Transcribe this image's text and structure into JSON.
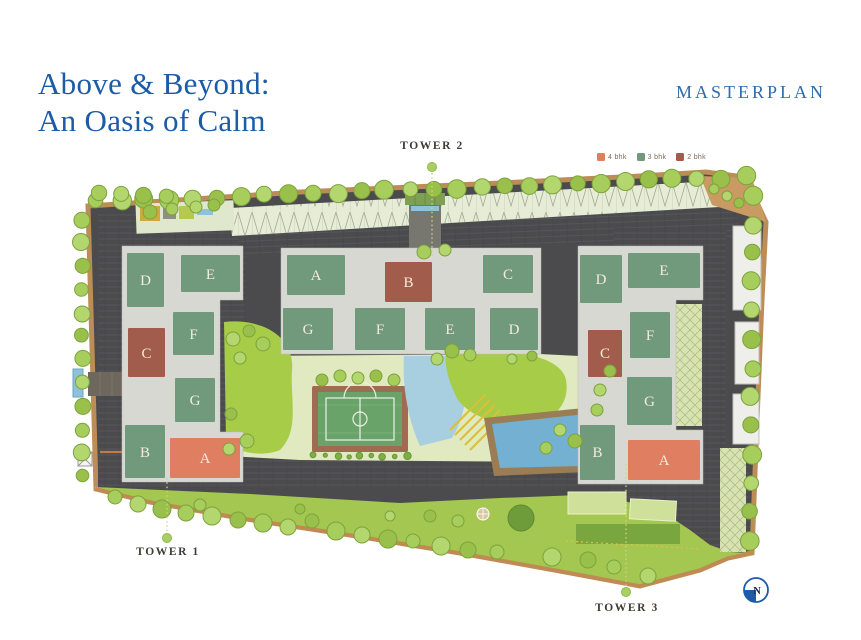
{
  "header": {
    "title_line1": "Above & Beyond:",
    "title_line2": "An Oasis of Calm",
    "corner_label": "MASTERPLAN"
  },
  "legend": {
    "items": [
      {
        "label": "4 bhk",
        "color": "#df7e60"
      },
      {
        "label": "3 bhk",
        "color": "#71997c"
      },
      {
        "label": "2 bhk",
        "color": "#a25c4b"
      }
    ]
  },
  "towers": [
    {
      "label": "TOWER 1",
      "blocks": [
        {
          "label": "D",
          "type": "3 bhk"
        },
        {
          "label": "E",
          "type": "3 bhk"
        },
        {
          "label": "C",
          "type": "2 bhk"
        },
        {
          "label": "F",
          "type": "3 bhk"
        },
        {
          "label": "G",
          "type": "3 bhk"
        },
        {
          "label": "B",
          "type": "3 bhk"
        },
        {
          "label": "A",
          "type": "4 bhk"
        }
      ]
    },
    {
      "label": "TOWER 2",
      "blocks": [
        {
          "label": "A",
          "type": "3 bhk"
        },
        {
          "label": "B",
          "type": "2 bhk"
        },
        {
          "label": "C",
          "type": "3 bhk"
        },
        {
          "label": "G",
          "type": "3 bhk"
        },
        {
          "label": "F",
          "type": "3 bhk"
        },
        {
          "label": "E",
          "type": "3 bhk"
        },
        {
          "label": "D",
          "type": "3 bhk"
        }
      ]
    },
    {
      "label": "TOWER 3",
      "blocks": [
        {
          "label": "D",
          "type": "3 bhk"
        },
        {
          "label": "E",
          "type": "3 bhk"
        },
        {
          "label": "C",
          "type": "2 bhk"
        },
        {
          "label": "F",
          "type": "3 bhk"
        },
        {
          "label": "G",
          "type": "3 bhk"
        },
        {
          "label": "B",
          "type": "3 bhk"
        },
        {
          "label": "A",
          "type": "4 bhk"
        }
      ]
    }
  ],
  "compass": {
    "label": "N"
  }
}
